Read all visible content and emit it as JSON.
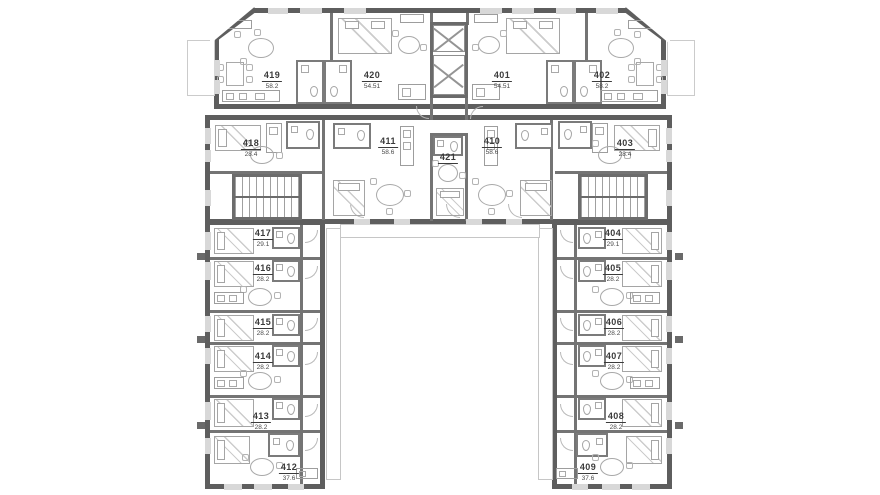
{
  "plan": {
    "type": "architectural-floor-plan",
    "colors": {
      "wall": "#5e5e5e",
      "partition": "#747474",
      "furniture": "#a9a9a9",
      "window": "#d8d8d8",
      "label_text": "#3b3b3b",
      "background": "#ffffff"
    }
  },
  "rooms": [
    {
      "number": "419",
      "area": "58.2"
    },
    {
      "number": "420",
      "area": "54.51"
    },
    {
      "number": "401",
      "area": "54.51"
    },
    {
      "number": "402",
      "area": "58.2"
    },
    {
      "number": "418",
      "area": "28.4"
    },
    {
      "number": "411",
      "area": "58.6"
    },
    {
      "number": "421"
    },
    {
      "number": "410",
      "area": "58.6"
    },
    {
      "number": "403",
      "area": "28.4"
    },
    {
      "number": "417",
      "area": "29.1"
    },
    {
      "number": "416",
      "area": "28.2"
    },
    {
      "number": "415",
      "area": "28.2"
    },
    {
      "number": "414",
      "area": "28.2"
    },
    {
      "number": "413",
      "area": "28.2"
    },
    {
      "number": "412",
      "area": "37.6"
    },
    {
      "number": "404",
      "area": "29.1"
    },
    {
      "number": "405",
      "area": "28.2"
    },
    {
      "number": "406",
      "area": "28.2"
    },
    {
      "number": "407",
      "area": "28.2"
    },
    {
      "number": "408",
      "area": "28.2"
    },
    {
      "number": "409",
      "area": "37.6"
    }
  ]
}
